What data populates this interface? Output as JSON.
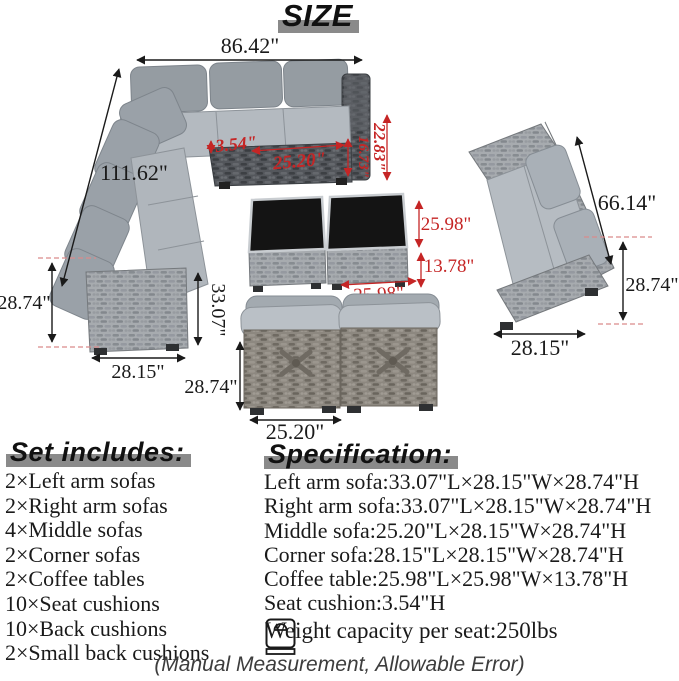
{
  "title": "SIZE",
  "dims": {
    "sectional": {
      "top_width": "86.42\"",
      "side_length": "111.62\"",
      "seat_height": "28.74\"",
      "depth": "28.15\"",
      "arm_length": "33.07\"",
      "cushion_thickness": "3.54\"",
      "seat_width": "25.20\"",
      "corner_inner": "16.73\"",
      "corner_back": "22.83\""
    },
    "coffee_table": {
      "top_depth": "25.98\"",
      "height": "13.78\"",
      "top_width": "25.98\""
    },
    "loveseat": {
      "length": "66.14\"",
      "seat_height": "28.74\"",
      "depth": "28.15\""
    },
    "middle_sofa": {
      "height": "28.74\"",
      "width": "25.20\""
    }
  },
  "set_includes": {
    "header": "Set includes:",
    "items": [
      "2×Left arm sofas",
      "2×Right arm sofas",
      "4×Middle sofas",
      "2×Corner sofas",
      "2×Coffee tables",
      "10×Seat cushions",
      "10×Back cushions",
      "2×Small back cushions"
    ]
  },
  "specification": {
    "header": "Specification:",
    "items": [
      "Left arm sofa:33.07\"L×28.15\"W×28.74\"H",
      "Right arm sofa:33.07\"L×28.15\"W×28.74\"H",
      "Middle sofa:25.20\"L×28.15\"W×28.74\"H",
      "Corner sofa:28.15\"L×28.15\"W×28.74\"H",
      "Coffee table:25.98\"L×25.98\"W×13.78\"H",
      "Seat cushion:3.54\"H"
    ],
    "weight_capacity": "Weight capacity per seat:250lbs"
  },
  "footnote": "(Manual Measurement, Allowable Error)",
  "icons": {
    "weight": "weight-scale-icon"
  },
  "colors": {
    "dimension_black": "#1a1a1a",
    "dimension_red": "#c52525",
    "header_band": "#8a8a8a",
    "cushion_gray": "#b4bac0",
    "back_cushion_gray": "#959ca2",
    "wicker_light": "#a7abaf",
    "wicker_dark": "#54575c",
    "wicker_taupe": "#8d8880",
    "glass_black": "#141414"
  }
}
